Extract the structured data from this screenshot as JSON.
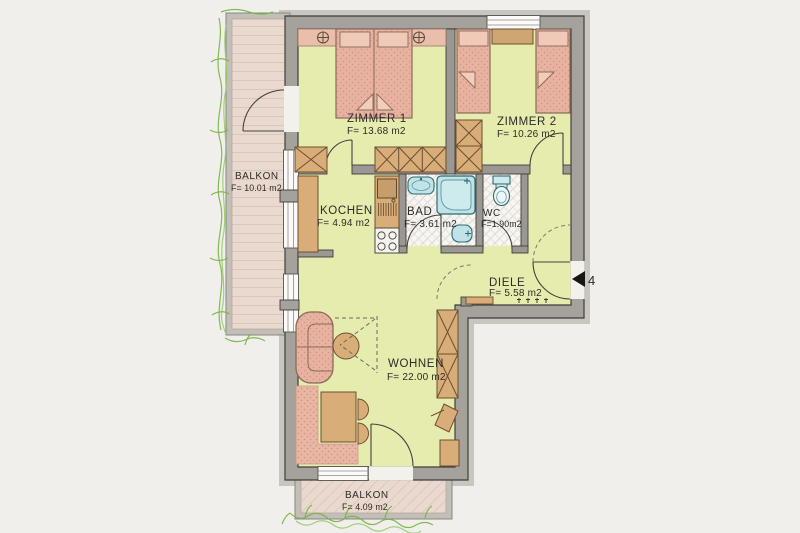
{
  "plan": {
    "type": "apartment-floor-plan",
    "rooms": {
      "balkonLeft": {
        "name": "BALKON",
        "area": "F= 10.01 m2"
      },
      "zimmer1": {
        "name": "ZIMMER 1",
        "area": "F= 13.68 m2"
      },
      "zimmer2": {
        "name": "ZIMMER 2",
        "area": "F= 10.26 m2"
      },
      "kochen": {
        "name": "KOCHEN",
        "area": "F= 4.94 m2"
      },
      "bad": {
        "name": "BAD",
        "area": "F= 3.61 m2"
      },
      "wc": {
        "name": "WC",
        "area": "F=1.90m2"
      },
      "diele": {
        "name": "DIELE",
        "area": "F= 5.58 m2"
      },
      "wohnen": {
        "name": "WOHNEN",
        "area": "F= 22.00 m2"
      },
      "balkonBottom": {
        "name": "BALKON",
        "area": "F= 4.09 m2"
      }
    },
    "entrance": {
      "number": "4",
      "marker": "left-pointing-triangle"
    },
    "colors": {
      "background": "#f1efec",
      "interiorFloor": "#e6ecae",
      "exteriorWall": "#a5a29c",
      "interiorWall": "#9b9893",
      "balconyFloor": "#ead9cf",
      "furniturePink": "#e8b2a0",
      "furnitureWood": "#d9ad77",
      "sanitaryCyan": "#bfe3e6",
      "bathTile": "#f8f6f2",
      "greenery": "#76b441"
    }
  }
}
